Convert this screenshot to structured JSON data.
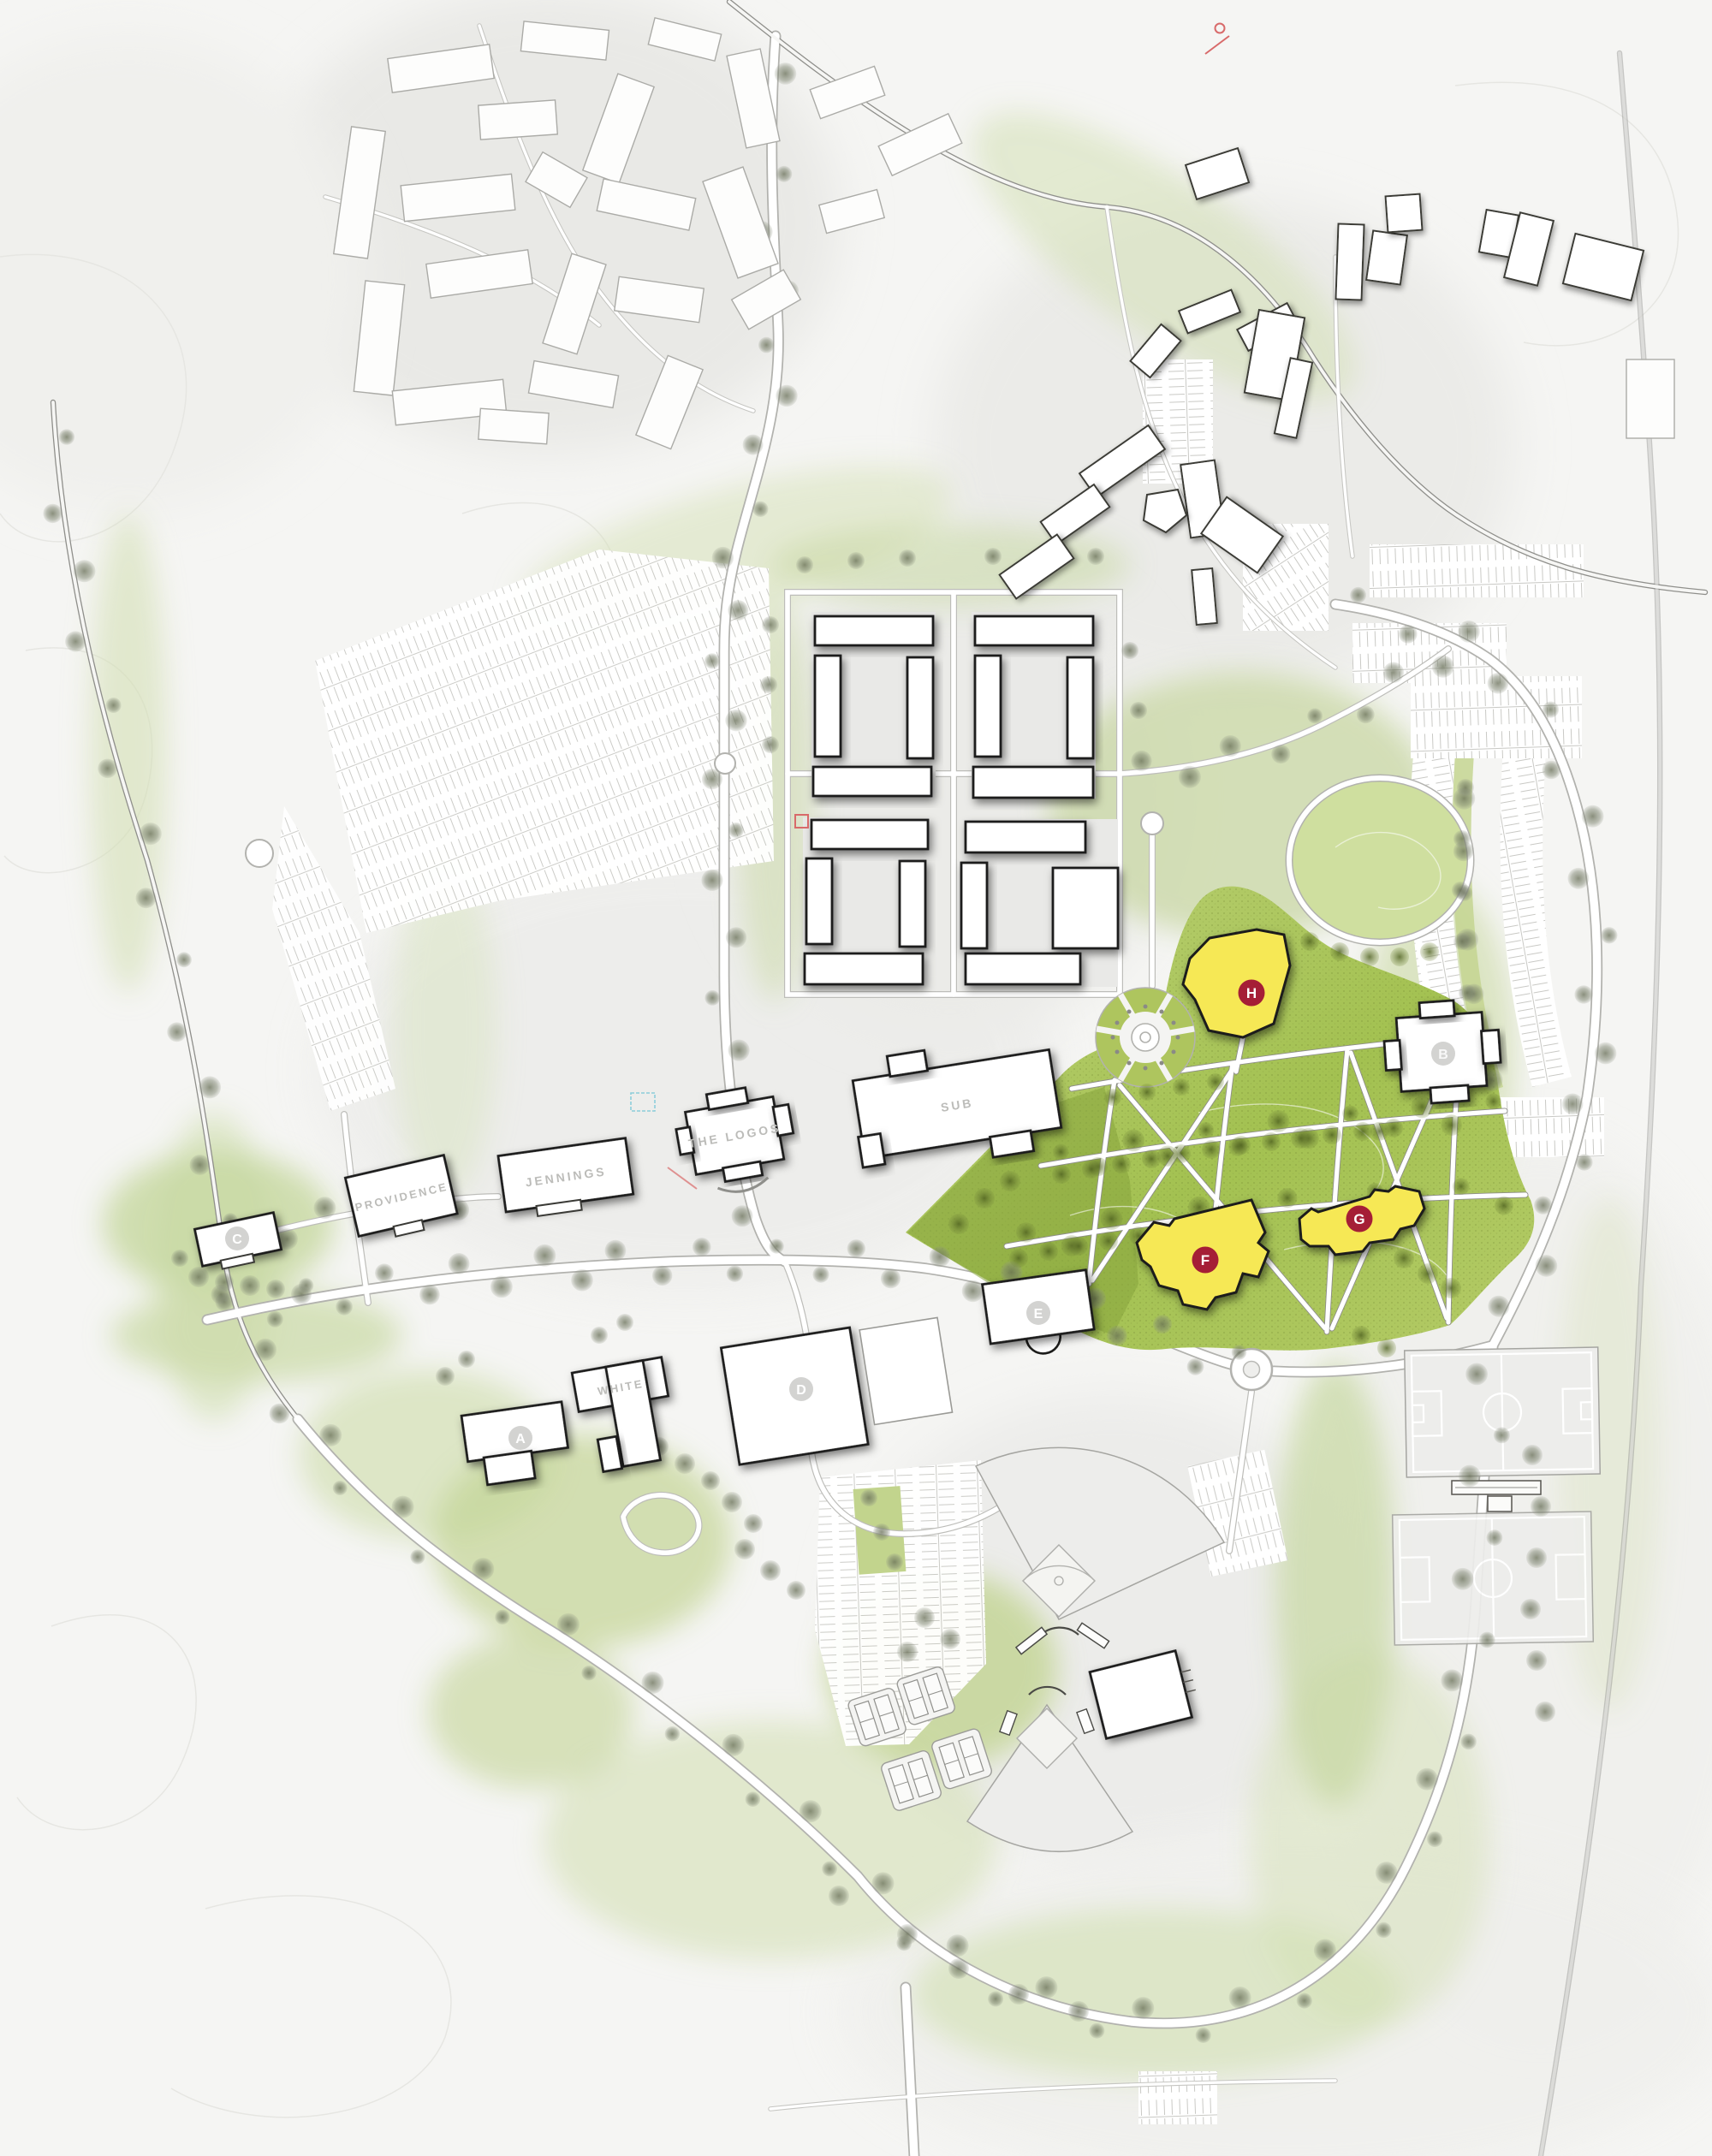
{
  "map": {
    "type": "campus-master-plan",
    "building_labels": {
      "sub": "SUB",
      "the_logos": "THE LOGOS",
      "jennings": "JENNINGS",
      "providence": "PROVIDENCE",
      "white": "WHITE"
    },
    "site_markers": {
      "existing": [
        "A",
        "B",
        "C",
        "D",
        "E"
      ],
      "proposed": [
        "F",
        "G",
        "H"
      ]
    },
    "colors": {
      "background": "#f5f5f3",
      "lawn_green": "#a3c151",
      "lawn_green_light": "#bdd177",
      "lawn_green_dark": "#87a43c",
      "oval_green": "#cfdf9f",
      "sage_wash": "#d3e0b4",
      "proposed_yellow": "#f6e854",
      "badge_crimson": "#a51e36",
      "marker_gray": "#c8c8c5",
      "label_gray": "#bcbcb9",
      "building_outline": "#1c1c1a",
      "road_casing": "#b2b2ae",
      "tree_olive": "#6e7f3c",
      "annotation_red": "#d86a6a"
    }
  }
}
